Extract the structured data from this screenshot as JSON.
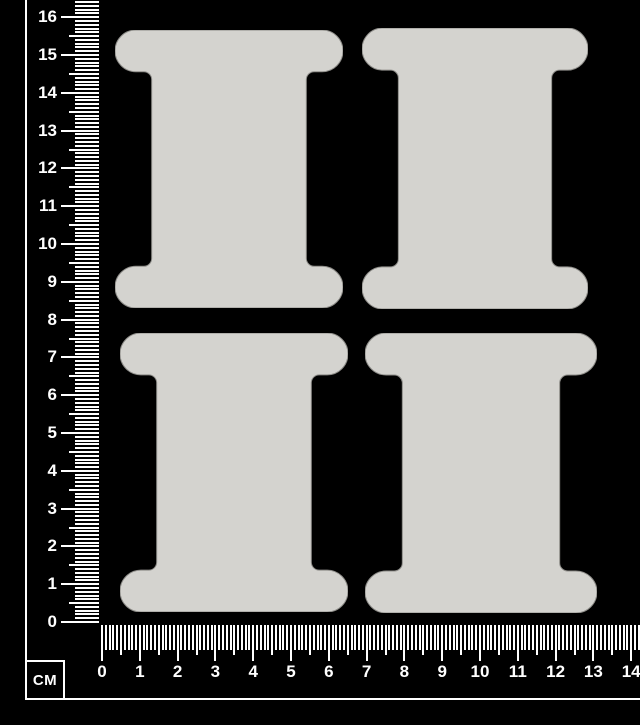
{
  "image": {
    "width": 640,
    "height": 725,
    "background_color": "#000000"
  },
  "ruler": {
    "unit_label": "CM",
    "color": "#ffffff",
    "px_per_cm": 37.8,
    "vertical": {
      "orientation": "vertical",
      "direction": "up",
      "labels": [
        "0",
        "1",
        "2",
        "3",
        "4",
        "5",
        "6",
        "7",
        "8",
        "9",
        "10",
        "11",
        "12",
        "13",
        "14",
        "15",
        "16"
      ]
    },
    "horizontal": {
      "orientation": "horizontal",
      "direction": "right",
      "labels": [
        "0",
        "1",
        "2",
        "3",
        "4",
        "5",
        "6",
        "7",
        "8",
        "9",
        "10",
        "11",
        "12",
        "13",
        "14"
      ]
    }
  },
  "spools": {
    "description_name": "spool-chipboard-shapes",
    "fill_color": "#d4d3cf",
    "edge_color": "#8e8d89",
    "count": 4,
    "shape": {
      "viewbox_w": 230,
      "viewbox_h": 280,
      "flange_h": 42,
      "end_radius": 21,
      "body_left": 37,
      "body_right": 193,
      "fillet_radius": 8
    },
    "items": [
      {
        "id": "spool-top-left",
        "x": 115,
        "y": 30,
        "width": 228,
        "height": 278
      },
      {
        "id": "spool-top-right",
        "x": 362,
        "y": 28,
        "width": 226,
        "height": 281
      },
      {
        "id": "spool-bottom-left",
        "x": 120,
        "y": 333,
        "width": 228,
        "height": 279
      },
      {
        "id": "spool-bottom-right",
        "x": 365,
        "y": 333,
        "width": 232,
        "height": 280
      }
    ]
  }
}
